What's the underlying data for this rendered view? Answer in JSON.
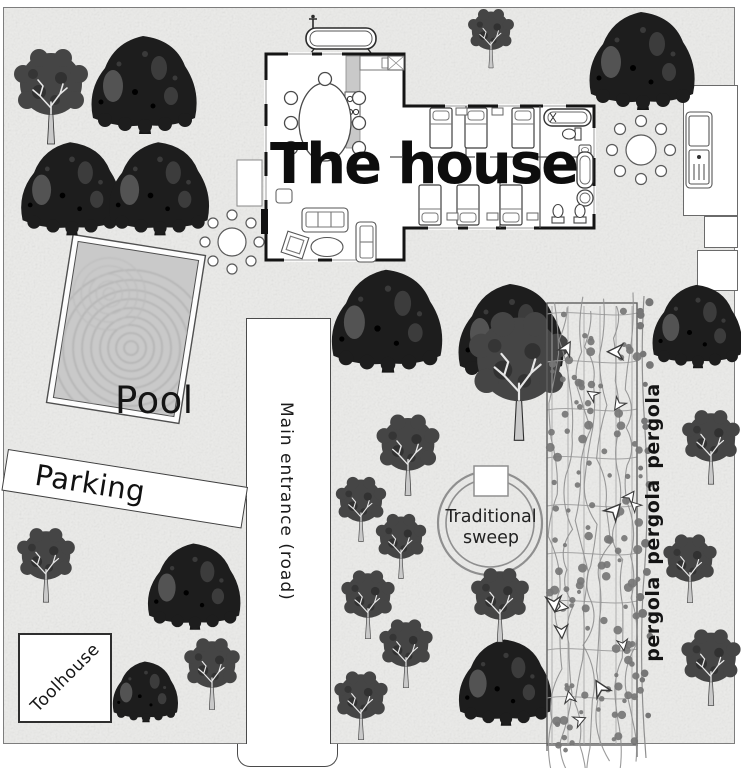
{
  "map": {
    "labels": {
      "house": "The house",
      "pool": "Pool",
      "parking": "Parking",
      "road": "Main entrance (road)",
      "sweep": [
        "Traditional",
        "sweep"
      ],
      "toolhouse": "Toolhouse",
      "pergola": [
        "pergola",
        "pergola",
        "pergola"
      ]
    },
    "colors": {
      "map_bg": "#ebebe9",
      "map_border": "#7d7d7d",
      "wall": "#141414",
      "furniture": "#555555",
      "water": "#c9c9c9",
      "ripple": "#b0b0b0",
      "tree_dark": "#1d1d1d",
      "tree_mid": "#454545",
      "tree_patch": "#5d5d5d",
      "branch_light": "#e6e6e6",
      "trellis": "#a9a9a9",
      "vine_stem": "#8f8f8f",
      "vine_leaf": "#767676",
      "pergola_border": "#5f5f5f",
      "label_text": "#111111"
    },
    "trees": [
      {
        "type": "B",
        "x": 145,
        "y": 82,
        "s": 1.0
      },
      {
        "type": "B",
        "x": 72,
        "y": 186,
        "s": 0.95
      },
      {
        "type": "B",
        "x": 160,
        "y": 186,
        "s": 0.95
      },
      {
        "type": "B",
        "x": 643,
        "y": 58,
        "s": 1.0
      },
      {
        "type": "B",
        "x": 388,
        "y": 318,
        "s": 1.05
      },
      {
        "type": "B",
        "x": 512,
        "y": 330,
        "s": 1.0
      },
      {
        "type": "B",
        "x": 698,
        "y": 324,
        "s": 0.85
      },
      {
        "type": "B",
        "x": 195,
        "y": 584,
        "s": 0.88
      },
      {
        "type": "B",
        "x": 146,
        "y": 690,
        "s": 0.62
      },
      {
        "type": "B",
        "x": 506,
        "y": 680,
        "s": 0.88
      },
      {
        "type": "A",
        "x": 51,
        "y": 86,
        "s": 1.0
      },
      {
        "type": "A",
        "x": 491,
        "y": 32,
        "s": 0.62
      },
      {
        "type": "A",
        "x": 519,
        "y": 362,
        "s": 1.35
      },
      {
        "type": "A",
        "x": 408,
        "y": 446,
        "s": 0.85
      },
      {
        "type": "A",
        "x": 361,
        "y": 502,
        "s": 0.68
      },
      {
        "type": "A",
        "x": 401,
        "y": 539,
        "s": 0.68
      },
      {
        "type": "A",
        "x": 711,
        "y": 439,
        "s": 0.78
      },
      {
        "type": "A",
        "x": 46,
        "y": 557,
        "s": 0.78
      },
      {
        "type": "A",
        "x": 212,
        "y": 666,
        "s": 0.75
      },
      {
        "type": "A",
        "x": 368,
        "y": 597,
        "s": 0.72
      },
      {
        "type": "A",
        "x": 406,
        "y": 646,
        "s": 0.72
      },
      {
        "type": "A",
        "x": 361,
        "y": 698,
        "s": 0.72
      },
      {
        "type": "A",
        "x": 500,
        "y": 597,
        "s": 0.78
      },
      {
        "type": "A",
        "x": 690,
        "y": 561,
        "s": 0.72
      },
      {
        "type": "A",
        "x": 711,
        "y": 659,
        "s": 0.8
      }
    ]
  }
}
